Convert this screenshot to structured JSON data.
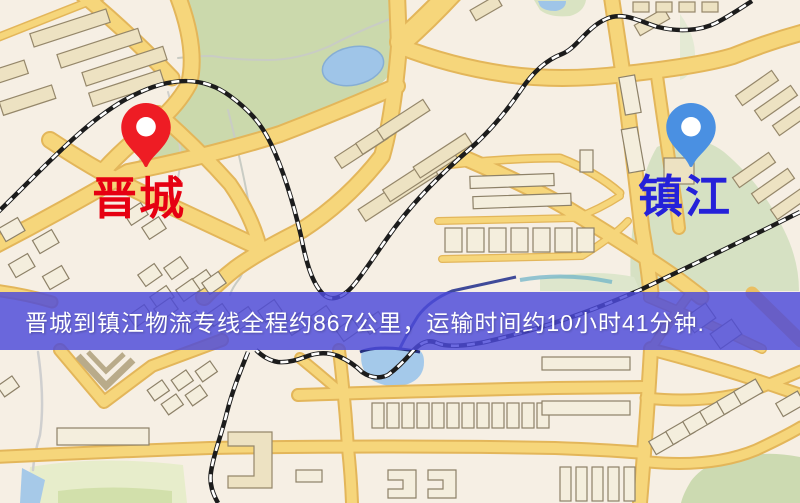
{
  "map": {
    "origin": {
      "label": "晋城",
      "pin_color": "#ee1c24",
      "label_color": "#e60012"
    },
    "destination": {
      "label": "镇江",
      "pin_color": "#4a90e2",
      "label_color": "#2521d9"
    },
    "colors": {
      "road_yellow": "#f6d67b",
      "park_green": "#cbd9ac",
      "water_blue": "#9fc5e8",
      "railway_black": "#1c1c1c",
      "background_cream": "#f6efe4"
    }
  },
  "banner": {
    "text": "晋城到镇江物流专线全程约867公里，运输时间约10小时41分钟.",
    "background_color": "#4d4ada",
    "text_color": "#ffffff",
    "distance_km": "867",
    "duration_text": "10小时41分钟"
  }
}
